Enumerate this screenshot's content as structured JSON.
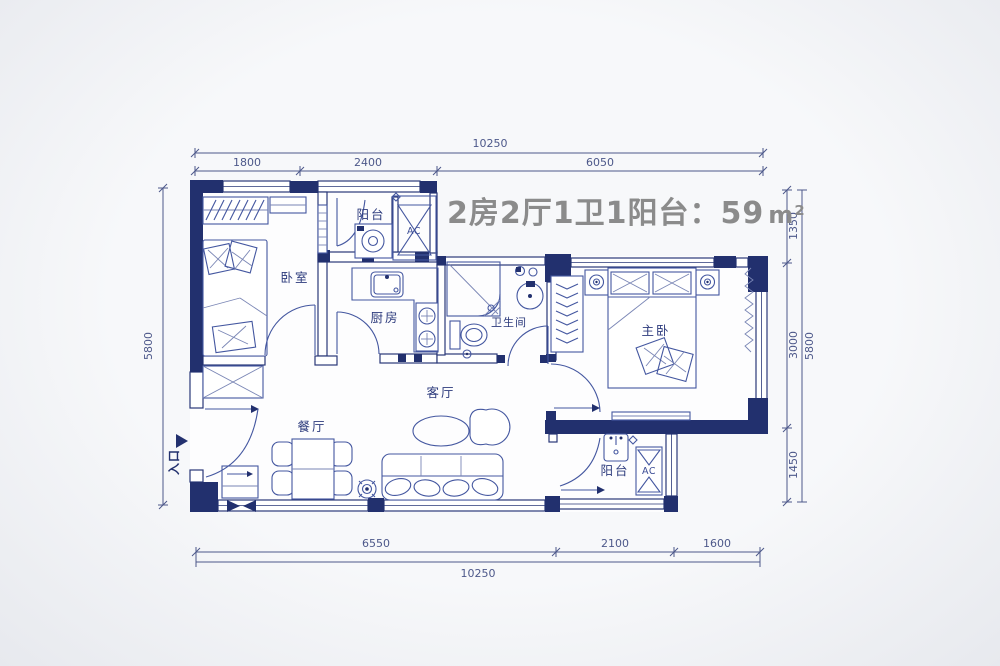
{
  "title": {
    "text": "2房2厅1卫1阳台：59",
    "unit": "m²"
  },
  "entrance": {
    "label": "入口"
  },
  "rooms": {
    "bedroom": "卧室",
    "balcony_top": "阳台",
    "ac_top": "AC",
    "kitchen": "厨房",
    "bathroom": "卫生间",
    "master_bedroom": "主卧",
    "living_room": "客厅",
    "dining_room": "餐厅",
    "balcony_bottom": "阳台",
    "ac_bottom": "AC"
  },
  "dimensions": {
    "top": {
      "total": "10250",
      "segments": [
        "1800",
        "2400",
        "6050"
      ]
    },
    "bottom": {
      "total": "10250",
      "segments": [
        "6550",
        "2100",
        "1600"
      ]
    },
    "left": {
      "total": "5800"
    },
    "right": {
      "total": "5800",
      "segments": [
        "1350",
        "3000",
        "1450"
      ]
    }
  },
  "colors": {
    "wall": "#22306e",
    "furniture_line": "#4457a0",
    "dimension": "#4d588a",
    "room_label": "#2c3a7c",
    "title": "#8b8b8b",
    "background": "#f2f3f5"
  }
}
